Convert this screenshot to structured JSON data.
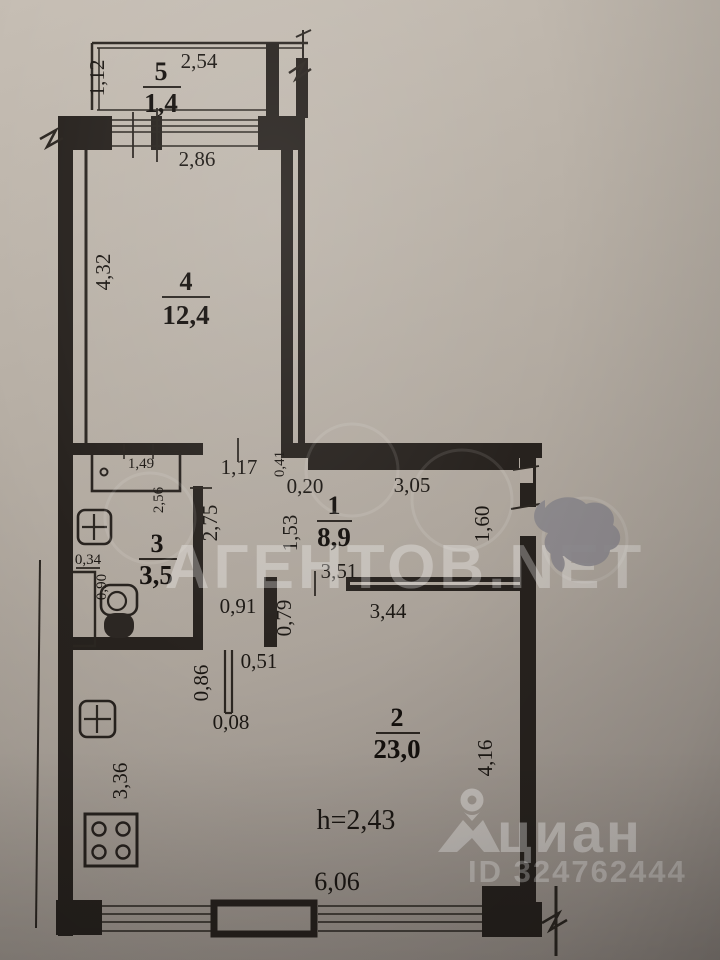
{
  "document_type": "apartment floor plan (BTI technical drawing, photographed)",
  "rooms": [
    {
      "number": "5",
      "area": "1,4"
    },
    {
      "number": "4",
      "area": "12,4"
    },
    {
      "number": "1",
      "area": "8,9"
    },
    {
      "number": "3",
      "area": "3,5"
    },
    {
      "number": "2",
      "area": "23,0"
    }
  ],
  "labels": [
    "1,12",
    "2,54",
    "2,86",
    "4,32",
    "1,49",
    "2,56",
    "1,17",
    "0,41",
    "0,20",
    "3,05",
    "2,75",
    "1,53",
    "1,60",
    "0,34",
    "0,90",
    "3,51",
    "0,91",
    "0,79",
    "3,44",
    "0,51",
    "0,86",
    "0,08",
    "4,16",
    "3,36",
    "h=2,43",
    "6,06"
  ],
  "watermarks": {
    "agency": "АГЕНТОВ.NET",
    "cian": "циан",
    "cian_id": "ID 324762444"
  },
  "colors": {
    "paper": "#b3aaa1",
    "ink": "#27221e",
    "watermark_white": "rgba(255,255,255,0.35)",
    "smudge_gray": "#8b888c"
  }
}
